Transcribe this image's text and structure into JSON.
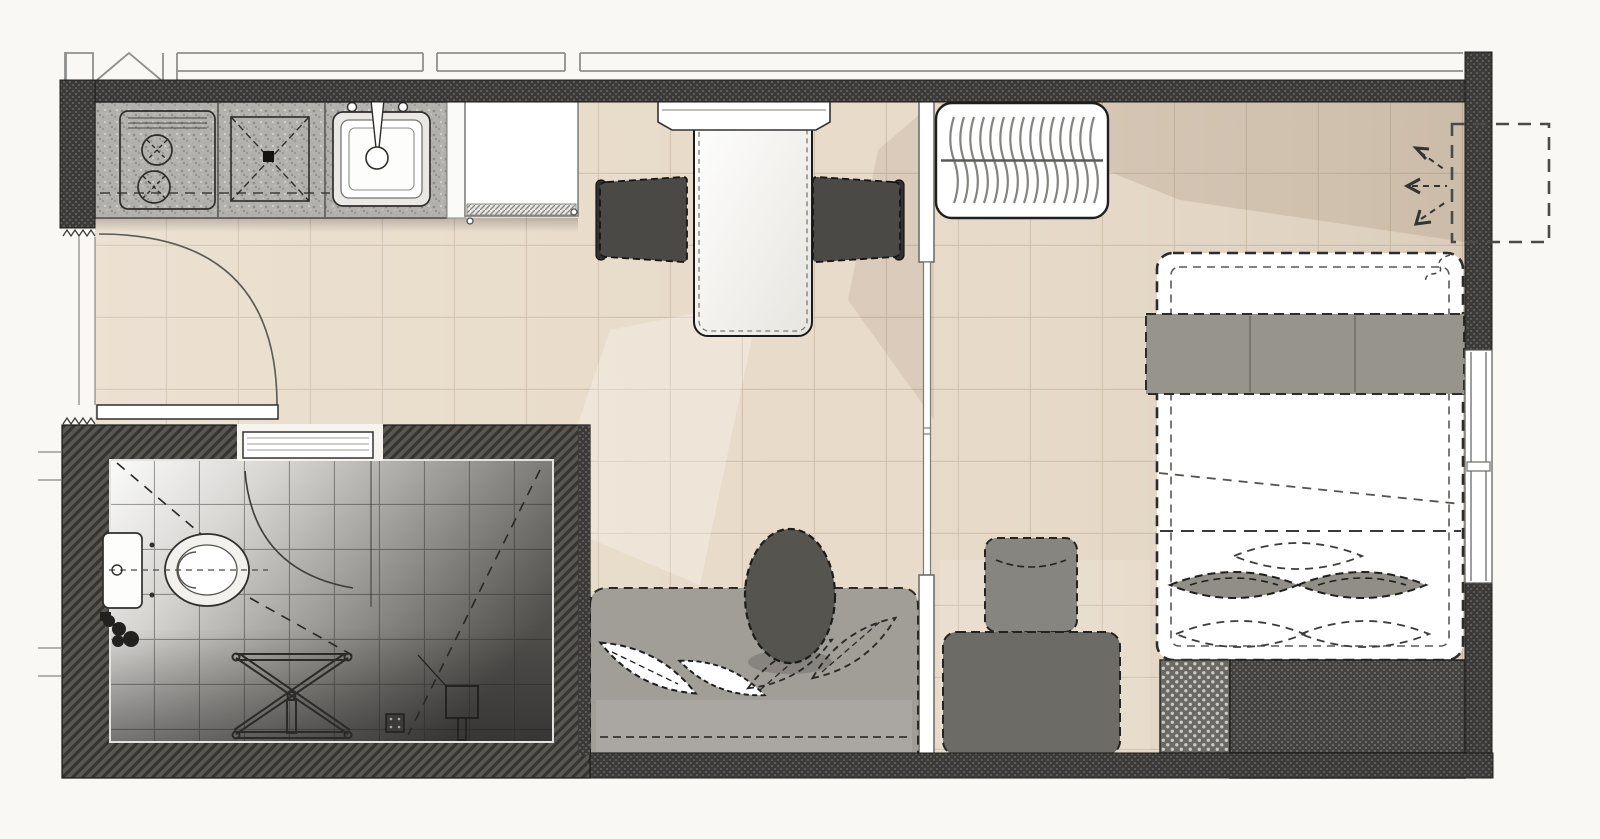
{
  "document": {
    "type": "architectural-floor-plan",
    "title": "Studio apartment floor plan — top-down architectural drawing",
    "visible_text": []
  },
  "colors": {
    "outside": "#faf8f4",
    "floor": "#e8dbc9",
    "floor-grid": "#d2c3af",
    "wall-dark": "#3b3a38",
    "wall-dot": "#5d5b57",
    "wardrobe": "#454341",
    "wardrobe-dot": "#6b6965",
    "bath-wall": "#595753",
    "bath-wall-line": "#37342f",
    "counter": "#b2b1ae",
    "sofa": "#a19e98",
    "chair": "#4b4946",
    "oval-table": "#56544f",
    "blanket": "#97948b",
    "pillow": "#908e86",
    "line-dark": "#2c2c2c",
    "white": "#ffffff"
  },
  "rooms": [
    {
      "name": "kitchen-entry",
      "items": [
        "entry-door",
        "kitchen-counter",
        "stove-cooktop",
        "worktop",
        "kitchen-sink",
        "refrigerator"
      ]
    },
    {
      "name": "living-dining",
      "items": [
        "dining-wall-cabinet",
        "dining-table",
        "dining-chair-left",
        "dining-chair-right",
        "sofa",
        "sofa-cushions",
        "oval-side-table",
        "glass-partition"
      ]
    },
    {
      "name": "bedroom",
      "items": [
        "radiator",
        "bed",
        "bed-blanket",
        "bed-pillows",
        "nightstand",
        "wardrobe",
        "lounge-chair",
        "window",
        "ac-vent",
        "airflow-arrows"
      ]
    },
    {
      "name": "bathroom",
      "items": [
        "bathroom-door",
        "toilet",
        "folding-stool",
        "shower-drain",
        "shower-head"
      ]
    }
  ]
}
